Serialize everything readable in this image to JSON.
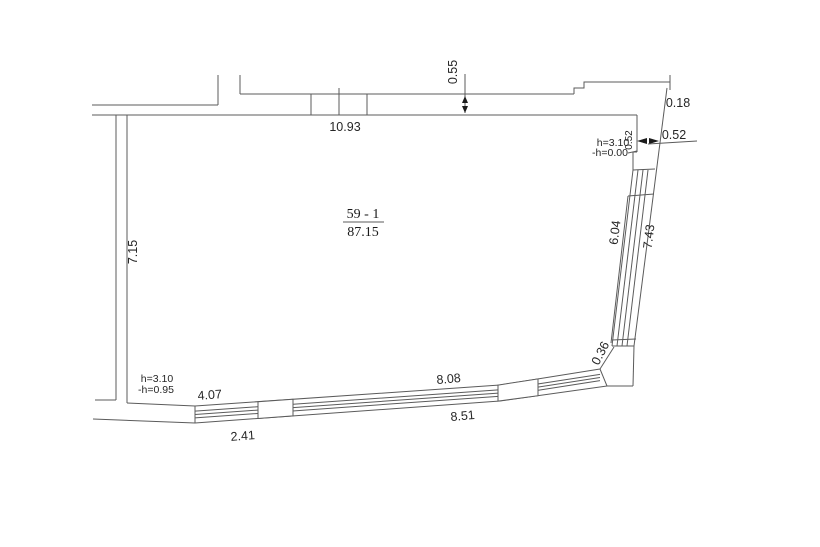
{
  "drawing": {
    "room": {
      "number": "59 - 1",
      "area": "87.15"
    },
    "dimensions": {
      "top_width": "10.93",
      "top_wall_thickness": "0.55",
      "top_right_offset": "0.18",
      "top_right_pier_rotated": "0.52",
      "top_right_pier": "0.52",
      "left_wall_length": "7.15",
      "right_window_length": "6.04",
      "right_wall_length": "7.43",
      "corner_segment": "0.36",
      "bottom_window_upper": "8.08",
      "bottom_window_lower": "8.51",
      "bottom_left_upper": "4.07",
      "bottom_left_lower": "2.41"
    },
    "annotations": {
      "top_right_height": "h=3.10",
      "top_right_level": "-h=0.00",
      "bottom_left_height": "h=3.10",
      "bottom_left_level": "-h=0.95"
    },
    "colors": {
      "line": "#5b5b5b",
      "text": "#262626",
      "background": "#ffffff"
    }
  }
}
